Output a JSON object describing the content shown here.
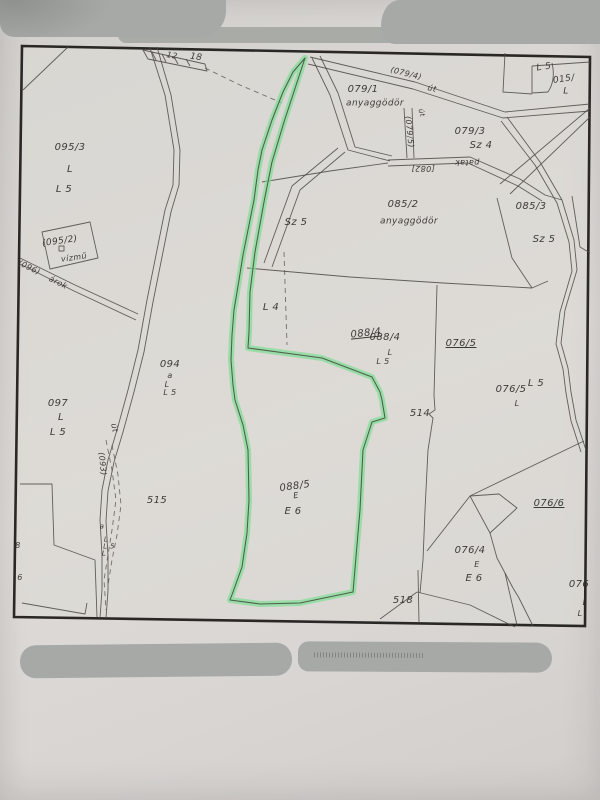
{
  "map": {
    "colors": {
      "paper": "#d9d6d3",
      "map_fill": "#dcdad6",
      "border": "#2a2825",
      "line": "#4f4c48",
      "label": "#2f2d2a",
      "highlight": "#7fdd95",
      "highlight_line": "#44503f",
      "redaction": "#a7a9a6"
    },
    "labels": [
      {
        "t": "12",
        "x": 172,
        "y": 56,
        "r": 10,
        "s": 8
      },
      {
        "t": "18",
        "x": 196,
        "y": 58,
        "r": 8,
        "s": 9
      },
      {
        "t": "095/3",
        "x": 70,
        "y": 148
      },
      {
        "t": "L",
        "x": 70,
        "y": 170
      },
      {
        "t": "L 5",
        "x": 64,
        "y": 190
      },
      {
        "t": "(095/2)",
        "x": 60,
        "y": 242,
        "r": -8,
        "s": 9
      },
      {
        "t": "vízmű",
        "x": 74,
        "y": 258,
        "r": -8,
        "s": 8
      },
      {
        "t": "(096)",
        "x": 29,
        "y": 268,
        "r": 26,
        "s": 8
      },
      {
        "t": "árok",
        "x": 58,
        "y": 283,
        "r": 26,
        "s": 8
      },
      {
        "t": "097",
        "x": 58,
        "y": 404
      },
      {
        "t": "L",
        "x": 61,
        "y": 418
      },
      {
        "t": "L 5",
        "x": 58,
        "y": 433
      },
      {
        "t": "094",
        "x": 170,
        "y": 365
      },
      {
        "t": "a",
        "x": 170,
        "y": 376,
        "s": 8
      },
      {
        "t": "L",
        "x": 167,
        "y": 385,
        "s": 8
      },
      {
        "t": "L 5",
        "x": 170,
        "y": 393,
        "s": 8
      },
      {
        "t": "515",
        "x": 157,
        "y": 501
      },
      {
        "t": "8",
        "x": 18,
        "y": 546,
        "s": 8
      },
      {
        "t": "6",
        "x": 20,
        "y": 578,
        "s": 8
      },
      {
        "t": "a",
        "x": 102,
        "y": 527,
        "s": 7
      },
      {
        "t": "L",
        "x": 106,
        "y": 540,
        "s": 7
      },
      {
        "t": "L 5",
        "x": 109,
        "y": 547,
        "s": 7
      },
      {
        "t": "L",
        "x": 104,
        "y": 554,
        "s": 7
      },
      {
        "t": "út",
        "x": 114,
        "y": 428,
        "r": 78,
        "s": 8
      },
      {
        "t": "(093)",
        "x": 102,
        "y": 464,
        "r": 84,
        "s": 8
      },
      {
        "t": "079/1",
        "x": 363,
        "y": 90
      },
      {
        "t": "anyaggödör",
        "x": 375,
        "y": 104,
        "s": 9
      },
      {
        "t": "(079/4)",
        "x": 406,
        "y": 74,
        "r": 14,
        "s": 8
      },
      {
        "t": "út",
        "x": 432,
        "y": 89,
        "r": 14,
        "s": 8
      },
      {
        "t": "út",
        "x": 421,
        "y": 113,
        "r": 75,
        "s": 7
      },
      {
        "t": "(079/5)",
        "x": 409,
        "y": 132,
        "r": 84,
        "s": 8
      },
      {
        "t": "[082]",
        "x": 423,
        "y": 168,
        "r": 180,
        "s": 8
      },
      {
        "t": "patak",
        "x": 467,
        "y": 162,
        "r": 180,
        "s": 8
      },
      {
        "t": "079/3",
        "x": 470,
        "y": 132
      },
      {
        "t": "Sz 4",
        "x": 481,
        "y": 146
      },
      {
        "t": "L 5",
        "x": 544,
        "y": 68,
        "r": -8,
        "s": 9
      },
      {
        "t": "015/",
        "x": 564,
        "y": 80,
        "r": -8,
        "s": 9
      },
      {
        "t": "L",
        "x": 566,
        "y": 92,
        "s": 9
      },
      {
        "t": "085/2",
        "x": 403,
        "y": 205
      },
      {
        "t": "anyaggödör",
        "x": 409,
        "y": 222,
        "s": 9
      },
      {
        "t": "085/3",
        "x": 531,
        "y": 207
      },
      {
        "t": "Sz 5",
        "x": 544,
        "y": 240
      },
      {
        "t": "Sz 5",
        "x": 296,
        "y": 223
      },
      {
        "t": "L 4",
        "x": 271,
        "y": 308
      },
      {
        "t": "088/4",
        "x": 366,
        "y": 334,
        "r": -6,
        "u": true
      },
      {
        "t": "088/4",
        "x": 385,
        "y": 338
      },
      {
        "t": "L",
        "x": 390,
        "y": 353,
        "s": 8
      },
      {
        "t": "L 5",
        "x": 383,
        "y": 362,
        "s": 8
      },
      {
        "t": "076/5",
        "x": 461,
        "y": 344,
        "u": true
      },
      {
        "t": "076/5",
        "x": 511,
        "y": 390
      },
      {
        "t": "L 5",
        "x": 536,
        "y": 384
      },
      {
        "t": "L",
        "x": 517,
        "y": 404,
        "s": 8
      },
      {
        "t": "514",
        "x": 420,
        "y": 414
      },
      {
        "t": "088/5",
        "x": 295,
        "y": 487,
        "r": -8
      },
      {
        "t": "E",
        "x": 296,
        "y": 496,
        "r": -8,
        "s": 8
      },
      {
        "t": "E 6",
        "x": 293,
        "y": 512
      },
      {
        "t": "076/6",
        "x": 549,
        "y": 504,
        "u": true
      },
      {
        "t": "076/4",
        "x": 470,
        "y": 551
      },
      {
        "t": "E",
        "x": 477,
        "y": 565,
        "s": 8
      },
      {
        "t": "E 6",
        "x": 474,
        "y": 579
      },
      {
        "t": "518",
        "x": 403,
        "y": 601
      },
      {
        "t": "076",
        "x": 579,
        "y": 585
      },
      {
        "t": "L",
        "x": 585,
        "y": 603,
        "s": 8
      },
      {
        "t": "L",
        "x": 580,
        "y": 614,
        "s": 8
      }
    ]
  }
}
